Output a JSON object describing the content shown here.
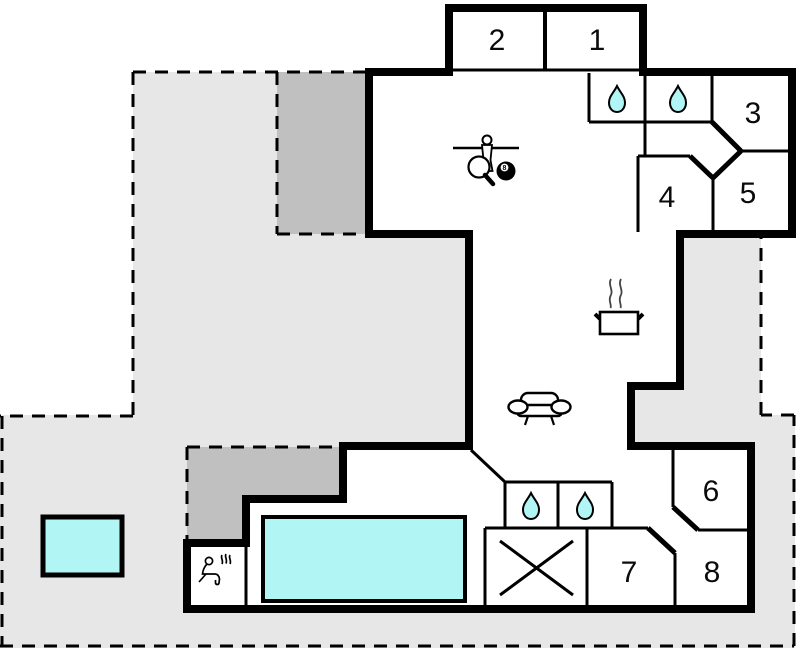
{
  "plan_title": "holiday-house-floor-plan",
  "rooms": [
    {
      "number": "1"
    },
    {
      "number": "2"
    },
    {
      "number": "3"
    },
    {
      "number": "4"
    },
    {
      "number": "5"
    },
    {
      "number": "6"
    },
    {
      "number": "7"
    },
    {
      "number": "8"
    }
  ],
  "icons": {
    "billiard_ball_label": "8",
    "bathroom": "water-drop",
    "games_room": "foosball-tabletennis-billiards",
    "kitchen": "steaming-pot",
    "living_room": "sofa",
    "sauna": "seated-person-with-steam",
    "storage": "crossed-box"
  },
  "colors": {
    "water": "#b2f5f5",
    "terrace": "#e7e7e7",
    "covered_terrace": "#c0c0c0",
    "wall": "#000000",
    "floor": "#ffffff"
  }
}
